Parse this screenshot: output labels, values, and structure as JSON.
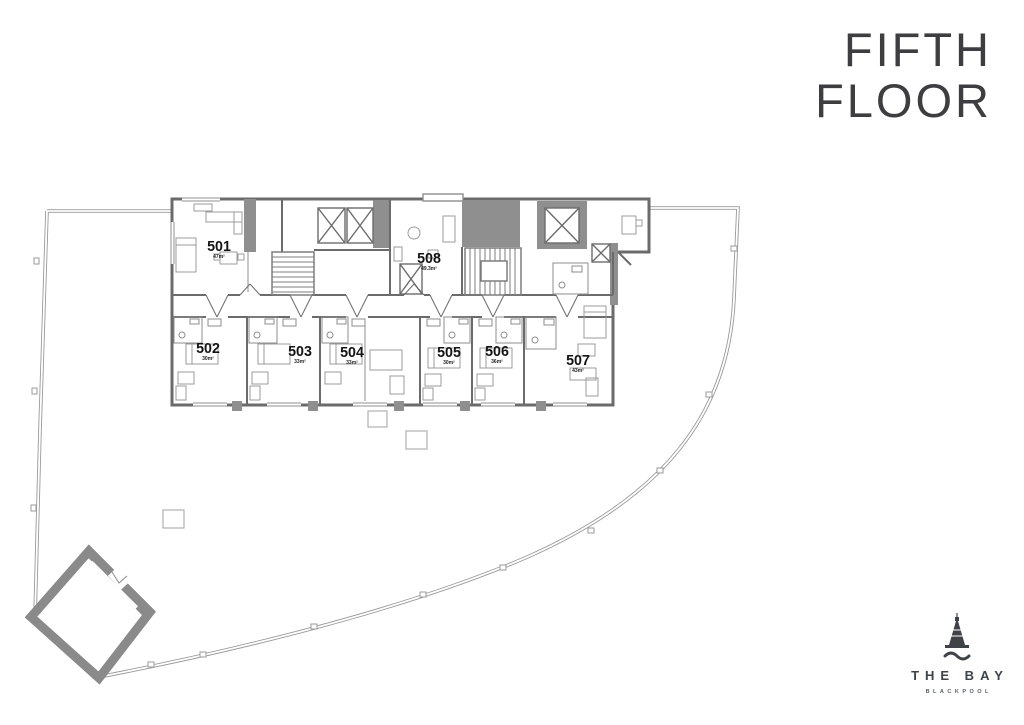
{
  "title": {
    "line1": "FIFTH",
    "line2": "FLOOR"
  },
  "units": [
    {
      "number": "501",
      "area": "47m²"
    },
    {
      "number": "502",
      "area": "30m²"
    },
    {
      "number": "503",
      "area": "33m²"
    },
    {
      "number": "504",
      "area": "33m²"
    },
    {
      "number": "505",
      "area": "30m²"
    },
    {
      "number": "506",
      "area": "36m²"
    },
    {
      "number": "507",
      "area": "43m²"
    },
    {
      "number": "508",
      "area": "49.3m²"
    }
  ],
  "logo": {
    "name": "THE BAY",
    "city": "BLACKPOOL",
    "icon": "blackpool-tower-icon"
  },
  "colors": {
    "boundary": "#9a9a9a",
    "wall": "#6b6b6b",
    "poche": "#8f8f8f",
    "furniture": "#9b9b9b",
    "ink": "#141414",
    "title": "#3e3e40"
  }
}
